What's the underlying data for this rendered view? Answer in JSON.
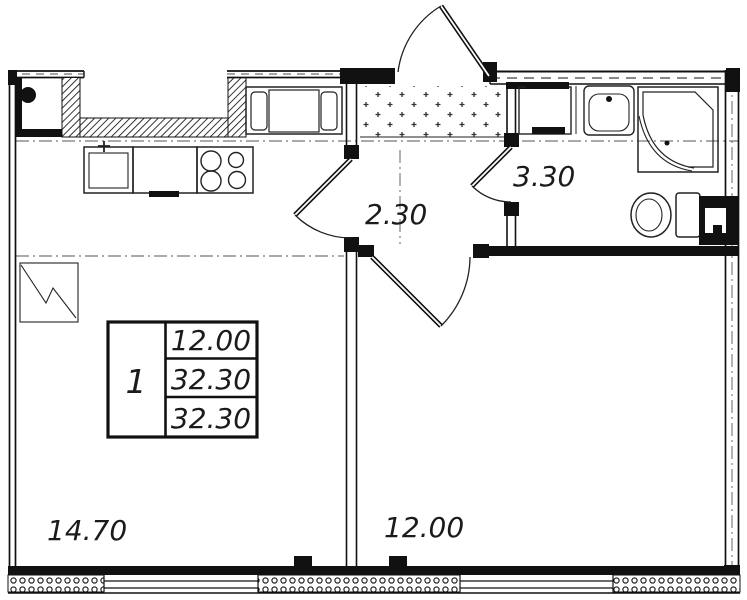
{
  "plan": {
    "stamp": {
      "rooms": "1",
      "living_area": "12.00",
      "total_area": "32.30",
      "total_area_full": "32.30"
    },
    "labels": {
      "kitchen_living": "14.70",
      "bedroom": "12.00",
      "hallway": "2.30",
      "bathroom": "3.30"
    },
    "colors": {
      "walls": "#111111",
      "thin_lines": "#222222",
      "axis_lines": "#555555",
      "background": "#ffffff"
    }
  }
}
